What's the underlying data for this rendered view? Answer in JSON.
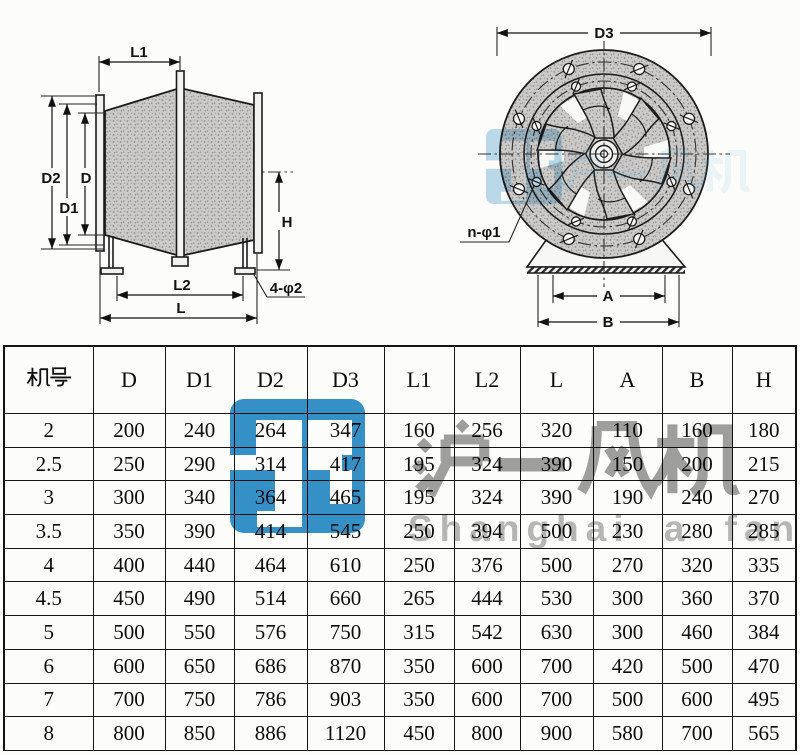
{
  "brand": {
    "logo_color": "#1f86c3",
    "name_cn": "沪一风机",
    "name_en": "Shanghai a fan"
  },
  "side_view": {
    "labels": {
      "L1": "L1",
      "D2": "D2",
      "D": "D",
      "D1": "D1",
      "H": "H",
      "L2": "L2",
      "L": "L",
      "holes": "4-φ2"
    }
  },
  "front_view": {
    "labels": {
      "D3": "D3",
      "holes": "n-φ1",
      "A": "A",
      "B": "B"
    }
  },
  "table": {
    "model_header": "机号",
    "headers": [
      "机号",
      "D",
      "D1",
      "D2",
      "D3",
      "L1",
      "L2",
      "L",
      "A",
      "B",
      "H"
    ],
    "rows": [
      [
        "2",
        "200",
        "240",
        "264",
        "347",
        "160",
        "256",
        "320",
        "110",
        "160",
        "180"
      ],
      [
        "2.5",
        "250",
        "290",
        "314",
        "417",
        "195",
        "324",
        "390",
        "150",
        "200",
        "215"
      ],
      [
        "3",
        "300",
        "340",
        "364",
        "465",
        "195",
        "324",
        "390",
        "190",
        "240",
        "270"
      ],
      [
        "3.5",
        "350",
        "390",
        "414",
        "545",
        "250",
        "394",
        "500",
        "230",
        "280",
        "285"
      ],
      [
        "4",
        "400",
        "440",
        "464",
        "610",
        "250",
        "376",
        "500",
        "270",
        "320",
        "335"
      ],
      [
        "4.5",
        "450",
        "490",
        "514",
        "660",
        "265",
        "444",
        "530",
        "300",
        "360",
        "370"
      ],
      [
        "5",
        "500",
        "550",
        "576",
        "750",
        "315",
        "542",
        "630",
        "300",
        "460",
        "384"
      ],
      [
        "6",
        "600",
        "650",
        "686",
        "870",
        "350",
        "600",
        "700",
        "420",
        "500",
        "470"
      ],
      [
        "7",
        "700",
        "750",
        "786",
        "903",
        "350",
        "600",
        "700",
        "500",
        "600",
        "495"
      ],
      [
        "8",
        "800",
        "850",
        "886",
        "1120",
        "450",
        "800",
        "900",
        "580",
        "700",
        "565"
      ]
    ]
  }
}
